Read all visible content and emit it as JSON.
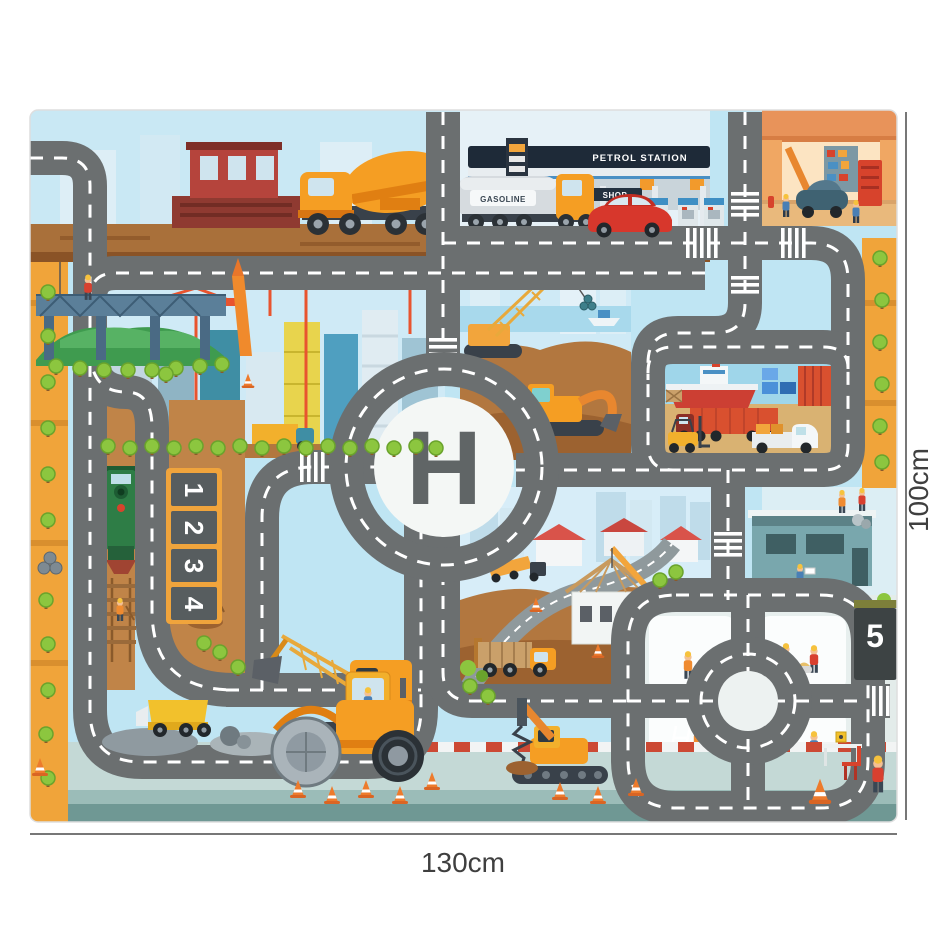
{
  "dimensions": {
    "width_label": "130cm",
    "height_label": "100cm"
  },
  "mat": {
    "helipad_letter": "H",
    "petrol_station": {
      "sign": "PETROL STATION",
      "shop_sign": "SHOP",
      "tanker_label": "GASOLINE"
    },
    "parking_spots": [
      "1",
      "2",
      "3",
      "4"
    ],
    "right_parking_spot": "5"
  },
  "colors": {
    "road": "#6b6f70",
    "road_line": "#ffffff",
    "sky": "#bfe5f3",
    "dirt": "#b2773f",
    "border_strip": "#f0a43a",
    "tree_green": "#8cc63f",
    "machine_orange": "#f59e23",
    "teal_building": "#7fd0cf",
    "brick_red": "#b5443c",
    "water": "#a8d9ec",
    "pavement": "#c4d9d6",
    "curb_red": "#cc4934",
    "sign_navy": "#1e2a38",
    "panel_gray": "#3d4344",
    "car_red": "#d7372c",
    "helipad_white": "#f4f7f5"
  }
}
